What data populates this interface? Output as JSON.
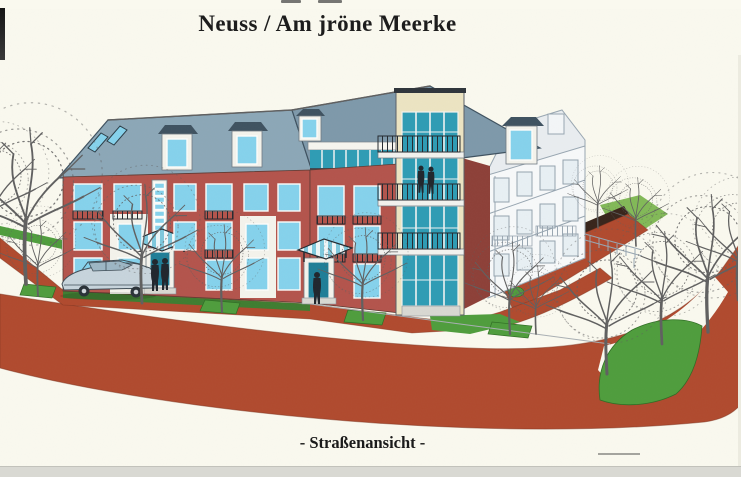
{
  "document": {
    "title": "Neuss / Am jröne Meerke",
    "caption": "- Straßenansicht -"
  },
  "scene": {
    "alt": "Colored architectural street-view rendering: three to four storey red brick apartment building with white stucco panels, glazed stairwell, teal glass corner tower with balconies, blue-grey slate roof with dormers, bare trees, green lawns, terracotta paved street curving right, a parked car and pedestrians."
  },
  "palette": {
    "page": "#faf9ef",
    "ink": "#1b1b1b",
    "roofA": "#8ca7b7",
    "roofB": "#7e99aa",
    "roofDark": "#3f5260",
    "brick": "#b3544c",
    "brickShade": "#8d4038",
    "stucco": "#f4f3ec",
    "window": "#85d2ec",
    "glassTeal": "#2e9cb4",
    "trim": "#ece4c2",
    "paving": "#b04a2e",
    "pavingDark": "#7d3320",
    "grass": "#4f9d3d",
    "grassDark": "#2f6d24",
    "grassLight": "#82b957",
    "wallDark": "#38251b",
    "treeLine": "#606060",
    "carBody": "#c7d4dc",
    "lineArt": "#98a6b1",
    "people": "#20262d",
    "scan": "#d9d9d3"
  }
}
